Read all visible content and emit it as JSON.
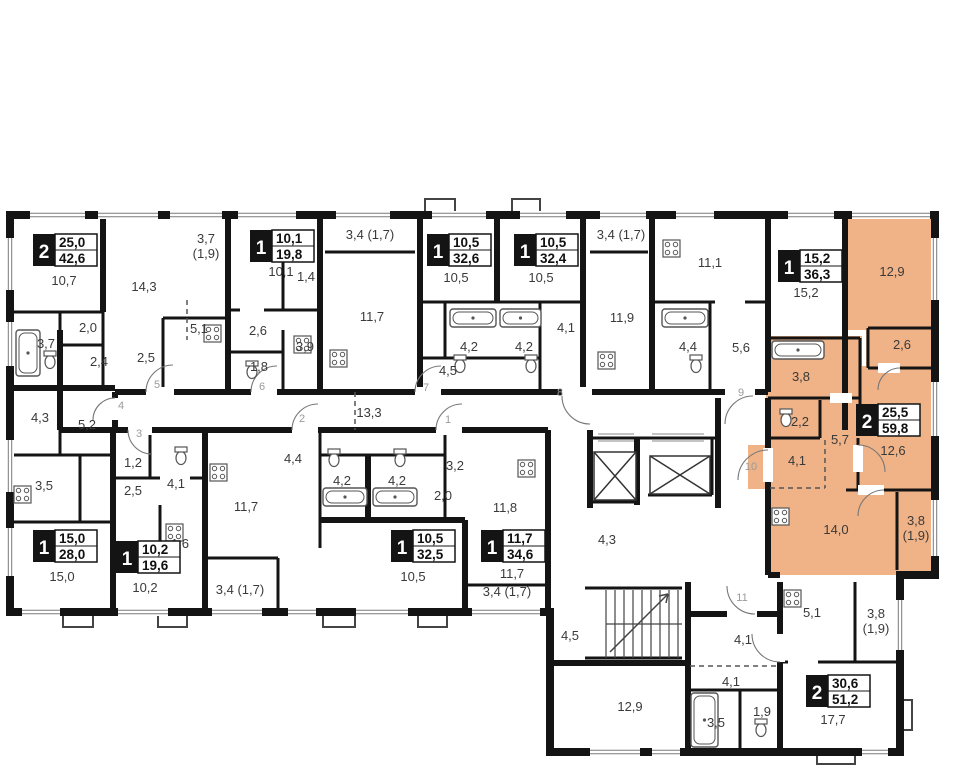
{
  "plan": {
    "canvas": {
      "width": 960,
      "height": 780
    },
    "colors": {
      "highlight": "#F0B287",
      "wall": "#141414",
      "label": "#3a3a3a",
      "door_number": "#9a9a9a",
      "fixture": "#555555"
    },
    "apartments": [
      {
        "id": "apt-a",
        "rooms": "2",
        "living": "25,0",
        "total": "42,6",
        "x": 33,
        "y": 234,
        "highlighted": false
      },
      {
        "id": "apt-b",
        "rooms": "1",
        "living": "10,1",
        "total": "19,8",
        "x": 250,
        "y": 230,
        "highlighted": false
      },
      {
        "id": "apt-c",
        "rooms": "1",
        "living": "10,5",
        "total": "32,6",
        "x": 427,
        "y": 234,
        "highlighted": false
      },
      {
        "id": "apt-d",
        "rooms": "1",
        "living": "10,5",
        "total": "32,4",
        "x": 514,
        "y": 234,
        "highlighted": false
      },
      {
        "id": "apt-e",
        "rooms": "1",
        "living": "15,2",
        "total": "36,3",
        "x": 778,
        "y": 250,
        "highlighted": false
      },
      {
        "id": "apt-j",
        "rooms": "2",
        "living": "25,5",
        "total": "59,8",
        "x": 856,
        "y": 404,
        "highlighted": true
      },
      {
        "id": "apt-f",
        "rooms": "1",
        "living": "15,0",
        "total": "28,0",
        "x": 33,
        "y": 530,
        "highlighted": false
      },
      {
        "id": "apt-g",
        "rooms": "1",
        "living": "10,2",
        "total": "19,6",
        "x": 116,
        "y": 541,
        "highlighted": false
      },
      {
        "id": "apt-h",
        "rooms": "1",
        "living": "10,5",
        "total": "32,5",
        "x": 391,
        "y": 530,
        "highlighted": false
      },
      {
        "id": "apt-i",
        "rooms": "1",
        "living": "11,7",
        "total": "34,6",
        "x": 481,
        "y": 530,
        "highlighted": false
      },
      {
        "id": "apt-k",
        "rooms": "2",
        "living": "30,6",
        "total": "51,2",
        "x": 806,
        "y": 675,
        "highlighted": false
      }
    ],
    "room_labels": [
      {
        "t": "10,7",
        "x": 64,
        "y": 285
      },
      {
        "t": "14,3",
        "x": 144,
        "y": 291
      },
      {
        "t": "3,7",
        "t2": "(1,9)",
        "x": 206,
        "y": 243
      },
      {
        "t": "2,0",
        "x": 88,
        "y": 332
      },
      {
        "t": "3,7",
        "x": 46,
        "y": 348
      },
      {
        "t": "2,4",
        "x": 99,
        "y": 366
      },
      {
        "t": "2,5",
        "x": 146,
        "y": 362
      },
      {
        "t": "5,1",
        "x": 199,
        "y": 333
      },
      {
        "t": "10,1",
        "x": 281,
        "y": 276
      },
      {
        "t": "1,4",
        "x": 306,
        "y": 281
      },
      {
        "t": "2,6",
        "x": 258,
        "y": 335
      },
      {
        "t": "3,9",
        "x": 305,
        "y": 351
      },
      {
        "t": "1,8",
        "x": 259,
        "y": 371
      },
      {
        "t": "3,4 (1,7)",
        "x": 370,
        "y": 239
      },
      {
        "t": "11,7",
        "x": 372,
        "y": 321
      },
      {
        "t": "10,5",
        "x": 456,
        "y": 282
      },
      {
        "t": "4,2",
        "x": 469,
        "y": 351
      },
      {
        "t": "4,5",
        "x": 448,
        "y": 375
      },
      {
        "t": "10,5",
        "x": 541,
        "y": 282
      },
      {
        "t": "4,2",
        "x": 524,
        "y": 351
      },
      {
        "t": "4,1",
        "x": 566,
        "y": 332
      },
      {
        "t": "3,4 (1,7)",
        "x": 621,
        "y": 239
      },
      {
        "t": "11,9",
        "x": 622,
        "y": 322
      },
      {
        "t": "11,1",
        "x": 710,
        "y": 267
      },
      {
        "t": "4,4",
        "x": 688,
        "y": 351
      },
      {
        "t": "5,6",
        "x": 741,
        "y": 352
      },
      {
        "t": "15,2",
        "x": 806,
        "y": 297
      },
      {
        "t": "12,9",
        "x": 892,
        "y": 276
      },
      {
        "t": "2,6",
        "x": 902,
        "y": 349
      },
      {
        "t": "3,8",
        "x": 801,
        "y": 381
      },
      {
        "t": "2,2",
        "x": 800,
        "y": 426
      },
      {
        "t": "5,7",
        "x": 840,
        "y": 444
      },
      {
        "t": "4,1",
        "x": 797,
        "y": 465
      },
      {
        "t": "12,6",
        "x": 893,
        "y": 455
      },
      {
        "t": "14,0",
        "x": 836,
        "y": 534
      },
      {
        "t": "3,8",
        "t2": "(1,9)",
        "x": 916,
        "y": 525
      },
      {
        "t": "13,3",
        "x": 369,
        "y": 417
      },
      {
        "t": "4,3",
        "x": 40,
        "y": 422
      },
      {
        "t": "5,2",
        "x": 87,
        "y": 429
      },
      {
        "t": "3,5",
        "x": 44,
        "y": 490
      },
      {
        "t": "15,0",
        "x": 62,
        "y": 581
      },
      {
        "t": "1,2",
        "x": 133,
        "y": 467
      },
      {
        "t": "2,5",
        "x": 133,
        "y": 495
      },
      {
        "t": "4,1",
        "x": 176,
        "y": 488
      },
      {
        "t": "1,6",
        "x": 180,
        "y": 548
      },
      {
        "t": "10,2",
        "x": 145,
        "y": 592
      },
      {
        "t": "4,4",
        "x": 293,
        "y": 463
      },
      {
        "t": "4,2",
        "x": 342,
        "y": 485
      },
      {
        "t": "11,7",
        "x": 246,
        "y": 511
      },
      {
        "t": "10,5",
        "x": 413,
        "y": 581
      },
      {
        "t": "3,4 (1,7)",
        "x": 240,
        "y": 594
      },
      {
        "t": "4,2",
        "x": 397,
        "y": 485
      },
      {
        "t": "3,2",
        "x": 455,
        "y": 470
      },
      {
        "t": "2,0",
        "x": 443,
        "y": 500
      },
      {
        "t": "11,8",
        "x": 505,
        "y": 512
      },
      {
        "t": "11,7",
        "x": 512,
        "y": 578
      },
      {
        "t": "3,4 (1,7)",
        "x": 507,
        "y": 596
      },
      {
        "t": "4,3",
        "x": 607,
        "y": 544
      },
      {
        "t": "4,5",
        "x": 570,
        "y": 640
      },
      {
        "t": "4,1",
        "x": 743,
        "y": 644
      },
      {
        "t": "4,1",
        "x": 731,
        "y": 686
      },
      {
        "t": "12,9",
        "x": 630,
        "y": 711
      },
      {
        "t": "3,5",
        "x": 716,
        "y": 727
      },
      {
        "t": "1,9",
        "x": 762,
        "y": 716
      },
      {
        "t": "5,1",
        "x": 812,
        "y": 617
      },
      {
        "t": "3,8",
        "t2": "(1,9)",
        "x": 876,
        "y": 618
      },
      {
        "t": "17,7",
        "x": 833,
        "y": 724
      }
    ],
    "door_numbers": [
      {
        "n": "1",
        "x": 448,
        "y": 423
      },
      {
        "n": "2",
        "x": 302,
        "y": 422
      },
      {
        "n": "3",
        "x": 139,
        "y": 437
      },
      {
        "n": "4",
        "x": 121,
        "y": 409
      },
      {
        "n": "5",
        "x": 157,
        "y": 388
      },
      {
        "n": "6",
        "x": 262,
        "y": 390
      },
      {
        "n": "7",
        "x": 426,
        "y": 391
      },
      {
        "n": "8",
        "x": 560,
        "y": 396
      },
      {
        "n": "9",
        "x": 741,
        "y": 396
      },
      {
        "n": "10",
        "x": 751,
        "y": 470
      },
      {
        "n": "11",
        "x": 742,
        "y": 601
      }
    ],
    "fixtures": {
      "bathtubs": [
        {
          "x": 16,
          "y": 330,
          "w": 24,
          "h": 46
        },
        {
          "x": 450,
          "y": 309,
          "w": 46,
          "h": 18
        },
        {
          "x": 500,
          "y": 309,
          "w": 41,
          "h": 18
        },
        {
          "x": 662,
          "y": 309,
          "w": 46,
          "h": 18
        },
        {
          "x": 772,
          "y": 341,
          "w": 52,
          "h": 18
        },
        {
          "x": 323,
          "y": 488,
          "w": 44,
          "h": 18
        },
        {
          "x": 373,
          "y": 488,
          "w": 44,
          "h": 18
        },
        {
          "x": 691,
          "y": 693,
          "w": 27,
          "h": 54
        }
      ],
      "toilets": [
        {
          "x": 50,
          "y": 362
        },
        {
          "x": 252,
          "y": 372
        },
        {
          "x": 460,
          "y": 366
        },
        {
          "x": 531,
          "y": 366
        },
        {
          "x": 696,
          "y": 366
        },
        {
          "x": 786,
          "y": 420
        },
        {
          "x": 181,
          "y": 458
        },
        {
          "x": 334,
          "y": 460
        },
        {
          "x": 400,
          "y": 460
        },
        {
          "x": 761,
          "y": 730
        }
      ],
      "stoves": [
        {
          "x": 204,
          "y": 325
        },
        {
          "x": 294,
          "y": 336
        },
        {
          "x": 330,
          "y": 350
        },
        {
          "x": 598,
          "y": 352
        },
        {
          "x": 663,
          "y": 240
        },
        {
          "x": 210,
          "y": 464
        },
        {
          "x": 518,
          "y": 460
        },
        {
          "x": 772,
          "y": 508
        },
        {
          "x": 784,
          "y": 590
        },
        {
          "x": 14,
          "y": 486
        },
        {
          "x": 166,
          "y": 524
        }
      ]
    }
  }
}
